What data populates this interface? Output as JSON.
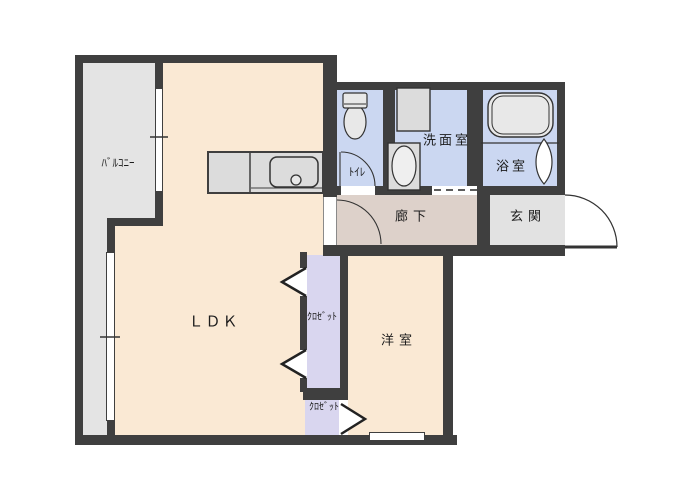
{
  "floorplan": {
    "kind": "japanese-apartment-floor-plan",
    "rooms": {
      "balcony": {
        "label": "ﾊﾞﾙｺﾆｰ"
      },
      "ldk": {
        "label": "ＬＤＫ"
      },
      "toilet": {
        "label": "ﾄｲﾚ"
      },
      "washroom": {
        "label": "洗面室"
      },
      "bathroom": {
        "label": "浴室"
      },
      "hallway": {
        "label": "廊下"
      },
      "entrance": {
        "label": "玄関"
      },
      "western_room": {
        "label": "洋室"
      },
      "closet_upper": {
        "label": "ｸﾛｾﾞｯﾄ"
      },
      "closet_lower": {
        "label": "ｸﾛｾﾞｯﾄ"
      }
    },
    "icons": [
      "kitchen-counter",
      "kitchen-sink",
      "toilet-fixture",
      "washing-machine-pan",
      "washbasin",
      "bathtub",
      "folding-bath-door",
      "door-swing-arc",
      "bifold-closet-door",
      "sliding-window"
    ],
    "colors": {
      "wall": "#3f3f3f",
      "room_cream": "#fae9d4",
      "room_blue": "#cbd7f1",
      "hallway_taupe": "#ddd1ca",
      "closet_lavender": "#d9d6ef",
      "balcony_gray": "#e4e4e4",
      "entrance_gray": "#e2e2e2",
      "fixture_gray": "#dcdcdc"
    }
  }
}
